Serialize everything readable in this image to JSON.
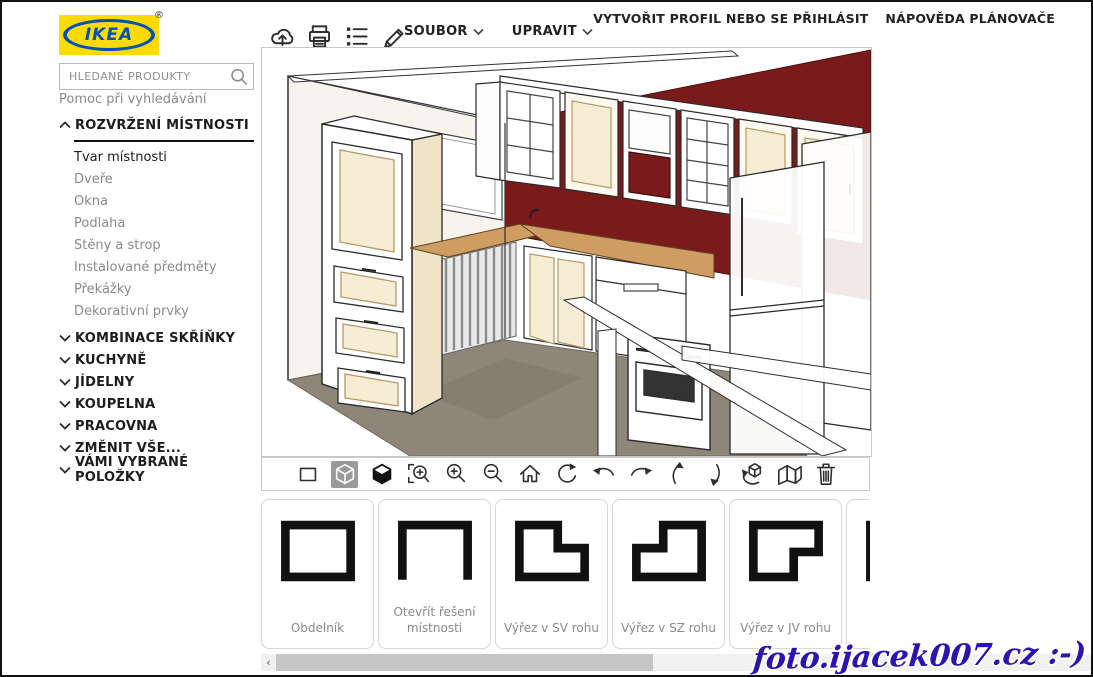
{
  "header": {
    "logo": {
      "brand": "IKEA",
      "registered": "®",
      "colors": {
        "yellow": "#ffdb00",
        "blue": "#0051ba"
      }
    },
    "quick_icons": [
      {
        "name": "publish-cloud-icon"
      },
      {
        "name": "print-icon"
      },
      {
        "name": "item-list-icon"
      },
      {
        "name": "pencil-edit-icon"
      }
    ],
    "menus": [
      {
        "label": "SOUBOR"
      },
      {
        "label": "UPRAVIT"
      }
    ],
    "links": [
      {
        "label": "VYTVOŘIT PROFIL NEBO SE PŘIHLÁSIT"
      },
      {
        "label": "NÁPOVĚDA PLÁNOVAČE"
      }
    ]
  },
  "sidebar": {
    "search": {
      "placeholder": "HLEDANÉ PRODUKTY",
      "icon": "search-icon"
    },
    "search_help": "Pomoc při vyhledávání",
    "sections": [
      {
        "label": "ROZVRŽENÍ MÍSTNOSTI",
        "expanded": true,
        "items": [
          "Tvar místnosti",
          "Dveře",
          "Okna",
          "Podlaha",
          "Stěny a strop",
          "Instalované předměty",
          "Překážky",
          "Dekorativní prvky"
        ],
        "selected_item": "Tvar místnosti"
      },
      {
        "label": "KOMBINACE SKŘÍŇKY",
        "expanded": false
      },
      {
        "label": "KUCHYNĚ",
        "expanded": false
      },
      {
        "label": "JÍDELNY",
        "expanded": false
      },
      {
        "label": "KOUPELNA",
        "expanded": false
      },
      {
        "label": "PRACOVNA",
        "expanded": false
      },
      {
        "label": "ZMĚNIT VŠE...",
        "expanded": false
      },
      {
        "label": "VÁMI VYBRANÉ POLOŽKY",
        "expanded": false
      }
    ]
  },
  "viewport": {
    "view": "3d",
    "toolbar": [
      {
        "name": "2d-view",
        "selected": false
      },
      {
        "name": "3d-view",
        "selected": true
      },
      {
        "name": "3d-solid-view",
        "selected": false
      },
      {
        "name": "zoom-selection",
        "selected": false
      },
      {
        "name": "zoom-in",
        "selected": false
      },
      {
        "name": "zoom-out",
        "selected": false
      },
      {
        "name": "home-view",
        "selected": false
      },
      {
        "name": "orbit-view",
        "selected": false
      },
      {
        "name": "rotate-left",
        "selected": false
      },
      {
        "name": "rotate-right",
        "selected": false
      },
      {
        "name": "tilt-up",
        "selected": false
      },
      {
        "name": "tilt-down",
        "selected": false
      },
      {
        "name": "rotate-object",
        "selected": false
      },
      {
        "name": "show-walls",
        "selected": false
      },
      {
        "name": "delete",
        "selected": false
      }
    ],
    "scene": {
      "description": "3D kitchen render: maroon back wall, cream cabinets, tan countertop, taupe floor, ghost outlines of dragged tall units",
      "colors": {
        "wall": "#7a1a1a",
        "countertop": "#cf9c62",
        "floor": "#8e8678",
        "cabinet_cream": "#f7ecd4"
      }
    }
  },
  "room_shapes": {
    "cards": [
      {
        "label": "Obdelník",
        "shape": "rectangle"
      },
      {
        "label": "Otevřít řešení místnosti",
        "shape": "open-bottom"
      },
      {
        "label": "Výřez v SV rohu",
        "shape": "notch-ne"
      },
      {
        "label": "Výřez v SZ rohu",
        "shape": "notch-nw"
      },
      {
        "label": "Výřez v JV rohu",
        "shape": "notch-se"
      },
      {
        "label": "Vý",
        "shape": "clipped"
      }
    ]
  },
  "scrollbar": {
    "left_arrow": "‹"
  },
  "watermark": "foto.ijacek007.cz :-)"
}
